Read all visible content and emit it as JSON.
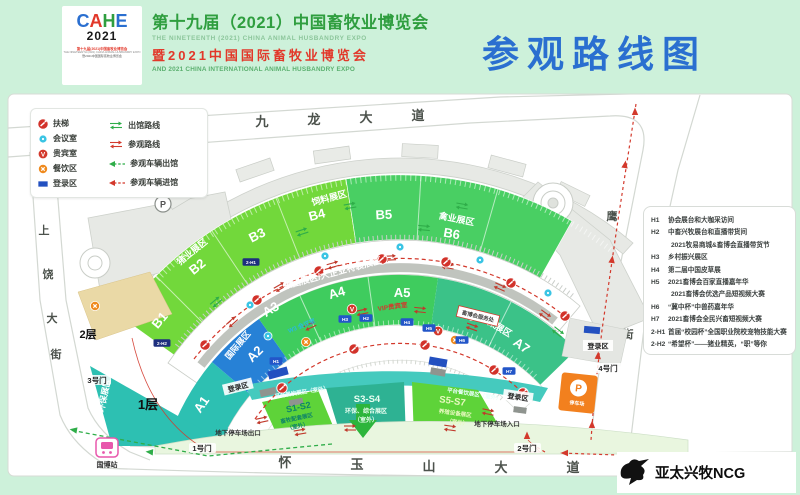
{
  "header": {
    "logo": {
      "letters": [
        "C",
        "A",
        "H",
        "E"
      ],
      "year": "2021",
      "tagline1": "第十九届(2021)中国畜牧业博览会",
      "tagline2": "THE NINETEENTH (2021) CHINA ANIMAL HUSBANDRY EXPO",
      "tagline3": "暨2021中国国际畜牧业博览会"
    },
    "title_cn": "第十九届（2021）中国畜牧业博览会",
    "title_en": "THE NINETEENTH (2021) CHINA ANIMAL HUSBANDRY EXPO",
    "subtitle_cn": "暨2021中国国际畜牧业博览会",
    "subtitle_en": "AND 2021 CHINA INTERNATIONAL ANIMAL HUSBANDRY EXPO",
    "page_title": "参观路线图"
  },
  "legend": {
    "facilities": [
      {
        "icon": "escalator-icon",
        "label": "扶梯"
      },
      {
        "icon": "meeting-room-icon",
        "label": "会议室"
      },
      {
        "icon": "vip-room-icon",
        "label": "贵宾室"
      },
      {
        "icon": "dining-icon",
        "label": "餐饮区"
      },
      {
        "icon": "registration-icon",
        "label": "登录区"
      }
    ],
    "routes": [
      {
        "icon": "green-double-arrow-icon",
        "label": "出馆路线"
      },
      {
        "icon": "red-double-arrow-icon",
        "label": "参观路线"
      },
      {
        "icon": "green-dash-arrow-icon",
        "label": "参观车辆出馆"
      },
      {
        "icon": "red-dash-arrow-icon",
        "label": "参观车辆进馆"
      }
    ]
  },
  "roads": {
    "north_chars": [
      "九",
      "龙",
      "大",
      "道"
    ],
    "south_chars": [
      "怀",
      "玉",
      "山",
      "大",
      "道"
    ],
    "west_chars": [
      "上",
      "饶",
      "大",
      "街"
    ],
    "east_chars": [
      "鹰",
      "潭",
      "街"
    ]
  },
  "gates": {
    "g1": "1号门",
    "g2": "2号门",
    "g3": "3号门",
    "g4": "4号门"
  },
  "station": "国博站",
  "floors": {
    "f1": "1层",
    "f2": "2层"
  },
  "halls": {
    "b": [
      "B1",
      "B2",
      "B3",
      "B4",
      "B5",
      "B6",
      "B7"
    ],
    "a": [
      "A1",
      "A2",
      "A3",
      "A4",
      "A5",
      "A6",
      "A7"
    ],
    "zones": {
      "pig": "猪业展区",
      "feed": "饲料展区",
      "poultry": "禽业展区",
      "group": "集团展区/大企业特装展区",
      "intl": "国际展区",
      "env": "环保展区",
      "animal_health": "动保展区"
    },
    "outdoor": {
      "s12": "S1-S2",
      "s12_desc": "畜牧配套展区",
      "s34": "S3-S4",
      "s34_desc": "环保、综合展区",
      "s57": "S5-S7",
      "s57_desc": "养殖设备展区",
      "suffix": "（室外）",
      "platform": "平台餐饮展区（室外）"
    }
  },
  "facilities": {
    "service": "畜博会服务处",
    "vip": "VIP贵宾室",
    "meeting": "W3 会议室",
    "reg": "登录区",
    "p_exit": "地下停车场出口",
    "p_entry": "地下停车场入口",
    "parking_letter": "P",
    "truck_park": "停车场"
  },
  "badges": {
    "h1": "H1",
    "h2": "H2",
    "h3": "H3",
    "h4": "H4",
    "h5": "H5",
    "h6": "H6",
    "h7": "H7",
    "h21": "2-H1",
    "h22": "2-H2"
  },
  "notes": [
    {
      "code": "H1",
      "text": "协会展台和大咖采访间"
    },
    {
      "code": "H2",
      "text": "中畜兴牧展台和直播带货间",
      "text2": "2021牧易商城&畜博会直播带货节"
    },
    {
      "code": "H3",
      "text": "乡村振兴展区"
    },
    {
      "code": "H4",
      "text": "第二届中国皮草展"
    },
    {
      "code": "H5",
      "text": "2021畜博会百家直播嘉年华",
      "text2": "2021畜博会优选产品短视频大赛"
    },
    {
      "code": "H6",
      "text": "“冀中杯”中兽药嘉年华"
    },
    {
      "code": "H7",
      "text": "2021畜博会全民兴畜短视频大赛"
    },
    {
      "code": "2-H1",
      "text": "首届“校园杯”全国职业院校宠物技能大赛"
    },
    {
      "code": "2-H2",
      "text": "“希望杯”——猪业精英，“职”等你"
    }
  ],
  "watermark": "亚太兴牧NCG",
  "colors": {
    "mint_bg": "#cdf1da",
    "title_blue": "#2a6fd0",
    "title_green": "#2f9e3f",
    "title_red": "#e2382a",
    "b_ring_left": "#72d83b",
    "b_ring_right": "#49cf63",
    "a_green": "#3fcc5e",
    "seagreen": "#3bc288",
    "teal": "#2dc0b2",
    "teal_wedge": "#2eb293",
    "blue_hall": "#2781d6",
    "badge_blue": "#2356c8",
    "badge_navy": "#1d2f7e",
    "route_red": "#d3392c",
    "route_green": "#2fad49",
    "orange": "#ef7f1c",
    "tan": "#ead9a6",
    "gray_roof": "#e7e9e5"
  }
}
